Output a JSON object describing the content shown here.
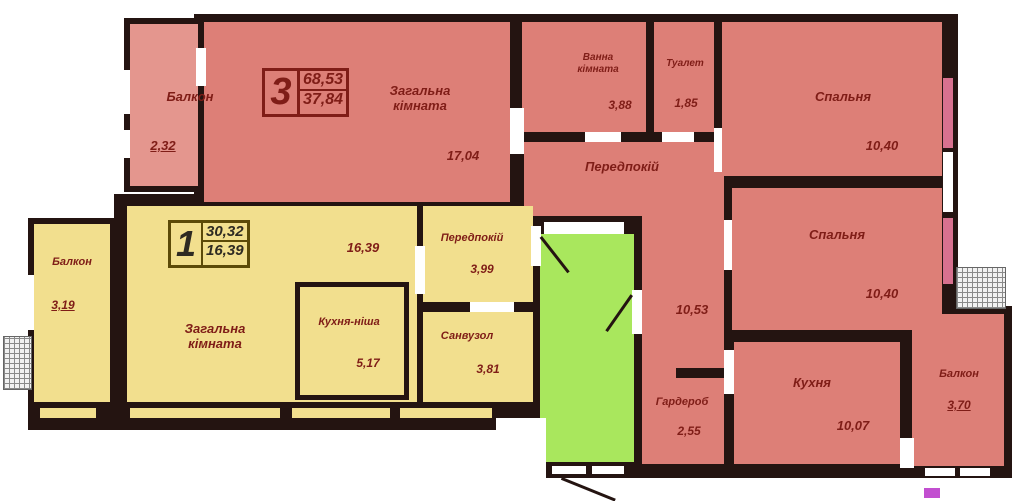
{
  "plan_title": "Поверховий план квартир",
  "apt3": {
    "stamp": {
      "number": "3",
      "area_total": "68,53",
      "area_living": "37,84"
    },
    "balcony_top": {
      "label": "Балкон",
      "area": "2,32"
    },
    "living": {
      "label": "Загальна кімната",
      "area": "17,04"
    },
    "bath": {
      "label": "Ванна кімната",
      "area": "3,88"
    },
    "toilet": {
      "label": "Туалет",
      "area": "1,85"
    },
    "bedroom1": {
      "label": "Спальня",
      "area": "10,40"
    },
    "hallway": {
      "label": "Передпокій",
      "area": "10,53"
    },
    "bedroom2": {
      "label": "Спальня",
      "area": "10,40"
    },
    "wardrobe": {
      "label": "Гардероб",
      "area": "2,55"
    },
    "kitchen": {
      "label": "Кухня",
      "area": "10,07"
    },
    "balcony_right": {
      "label": "Балкон",
      "area": "3,70"
    }
  },
  "apt1": {
    "stamp": {
      "number": "1",
      "area_total": "30,32",
      "area_living": "16,39"
    },
    "balcony_left": {
      "label": "Балкон",
      "area": "3,19"
    },
    "living": {
      "label": "Загальна кімната",
      "area": "16,39"
    },
    "kitchen_niche": {
      "label": "Кухня-ніша",
      "area": "5,17"
    },
    "hallway": {
      "label": "Передпокій",
      "area": "3,99"
    },
    "bathroom": {
      "label": "Санвузол",
      "area": "3,81"
    }
  },
  "colors": {
    "wall": "#241411",
    "apt3_fill": "#dd7f77",
    "apt3_balcony_fill": "#e4968e",
    "apt1_fill": "#f2df8e",
    "stairwell_fill": "#a9e75d",
    "window_pink": "#d8718f",
    "window_magenta": "#c24fd0",
    "label_text": "#7f1d17",
    "background": "#ffffff"
  }
}
